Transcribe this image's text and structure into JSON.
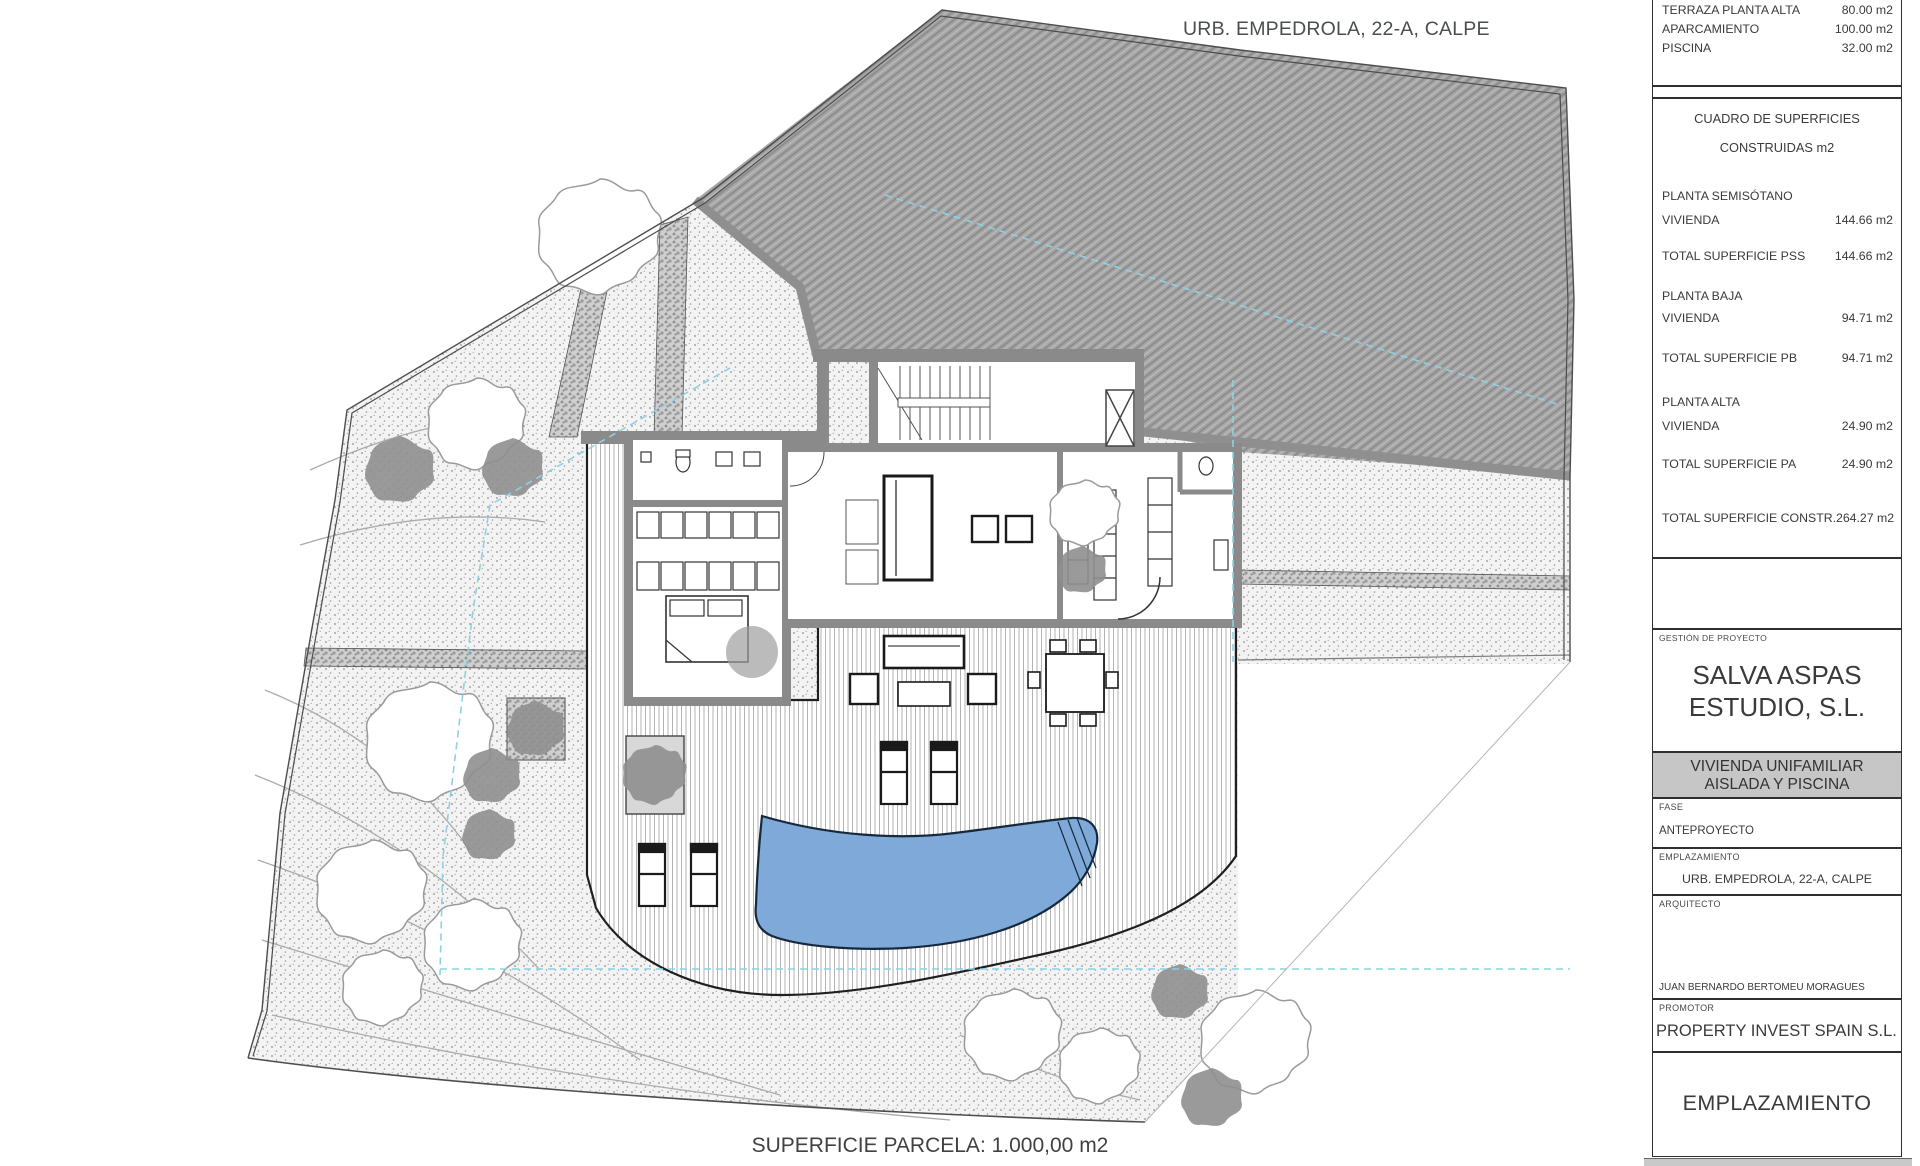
{
  "drawing_title": "URB. EMPEDROLA, 22-A, CALPE",
  "footer_note": "SUPERFICIE PARCELA: 1.000,00 m2",
  "title_block": {
    "areas_exteriores": {
      "rows": [
        {
          "label": "TERRAZA PLANTA ALTA",
          "value": "80.00 m2"
        },
        {
          "label": "APARCAMIENTO",
          "value": "100.00 m2"
        },
        {
          "label": "PISCINA",
          "value": "32.00 m2"
        }
      ]
    },
    "cuadro": {
      "title_line1": "CUADRO DE SUPERFICIES",
      "title_line2": "CONSTRUIDAS m2",
      "planta_semisotano": {
        "section": "PLANTA SEMISÓTANO",
        "vivienda_label": "VIVIENDA",
        "vivienda_value": "144.66 m2",
        "total_label": "TOTAL SUPERFICIE PSS",
        "total_value": "144.66 m2"
      },
      "planta_baja": {
        "section": "PLANTA BAJA",
        "vivienda_label": "VIVIENDA",
        "vivienda_value": "94.71 m2",
        "total_label": "TOTAL SUPERFICIE PB",
        "total_value": "94.71 m2"
      },
      "planta_alta": {
        "section": "PLANTA ALTA",
        "vivienda_label": "VIVIENDA",
        "vivienda_value": "24.90 m2",
        "total_label": "TOTAL SUPERFICIE PA",
        "total_value": "24.90 m2"
      },
      "total_label": "TOTAL SUPERFICIE CONSTR.",
      "total_value": "264.27 m2"
    },
    "gestion": {
      "label": "GESTIÓN DE PROYECTO",
      "name_line1": "SALVA ASPAS",
      "name_line2": "ESTUDIO, S.L."
    },
    "proyecto": {
      "line1": "VIVIENDA UNIFAMILIAR",
      "line2": "AISLADA Y PISCINA"
    },
    "fase": {
      "label": "FASE",
      "value": "ANTEPROYECTO"
    },
    "emplazamiento": {
      "label": "EMPLAZAMIENTO",
      "value": "URB. EMPEDROLA, 22-A, CALPE"
    },
    "arquitecto": {
      "label": "ARQUITECTO",
      "value": "JUAN BERNARDO BERTOMEU MORAGUES"
    },
    "promotor": {
      "label": "PROMOTOR",
      "value": "PROPERTY INVEST SPAIN S.L."
    },
    "sheet_title": "EMPLAZAMIENTO"
  },
  "colors": {
    "pool_water": "#7ea9d8",
    "hillside_hatch": "#a6a6a6",
    "wall_gray": "#8a8a8a",
    "setback_dashed": "#8ed1e4",
    "panel_gray": "#c6c6c6"
  }
}
